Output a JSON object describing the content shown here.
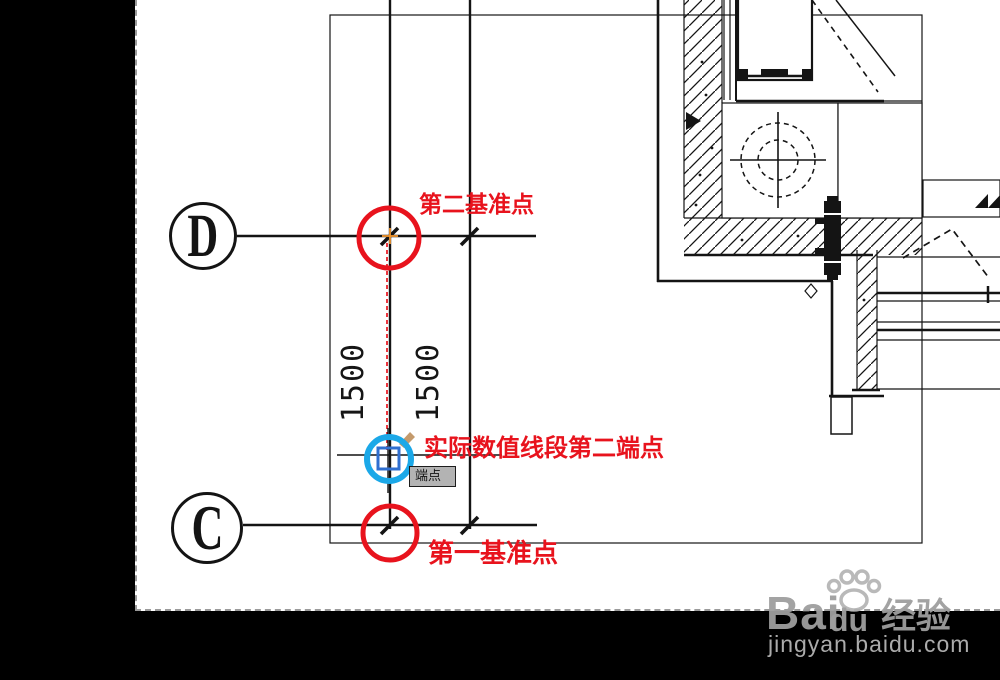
{
  "app": {
    "description": "CAD drawing screenshot with tutorial annotations",
    "canvas_background": "#ffffff",
    "letterbox_background": "#000000"
  },
  "grid_bubbles": {
    "d": "D",
    "c": "C"
  },
  "dimensions": {
    "values": [
      "1500",
      "1500"
    ]
  },
  "annotations": {
    "second_datum_label": "第二基准点",
    "second_endpoint_label": "实际数值线段第二端点",
    "first_datum_label": "第一基准点",
    "colors": {
      "highlight_red": "#e8131d",
      "highlight_blue": "#1ba8e8",
      "osnap_marker_blue": "#2f6fd0",
      "pick_point_orange": "#f0962e",
      "brush_tan": "#c49a6c"
    }
  },
  "tooltip": {
    "text": "端点",
    "background": "#b3b3b3"
  },
  "watermark": {
    "brand_part1": "Bai",
    "brand_part2": "du",
    "brand_cjk": "经验",
    "url": "jingyan.baidu.com",
    "color": "#9f9f9f"
  }
}
